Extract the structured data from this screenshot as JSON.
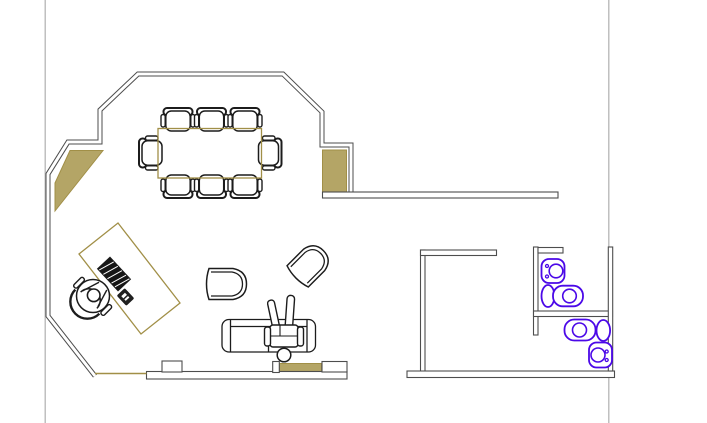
{
  "canvas": {
    "kind": "cad-floor-plan",
    "title": "Office floor plan with conference area, workstation, lounge and restroom"
  },
  "colors": {
    "background": "#ffffff",
    "wall_line": "#4d4d4d",
    "furniture_line": "#1c1c1c",
    "accent_fill": "#b4a566",
    "accent_line": "#a18f47",
    "fixture_line": "#4b08e8",
    "page_guide_line": "#b5b5b5"
  },
  "symbols": {
    "conference_table": 1,
    "conference_chairs": 8,
    "desk": 1,
    "desk_task_chair_with_person": 1,
    "keyboard_block": 1,
    "phone": 1,
    "tub_chairs": 2,
    "sofa": 1,
    "seated_person": 1,
    "toilets": 2,
    "wash_basins": 2,
    "wall_fill_panels": 3
  }
}
